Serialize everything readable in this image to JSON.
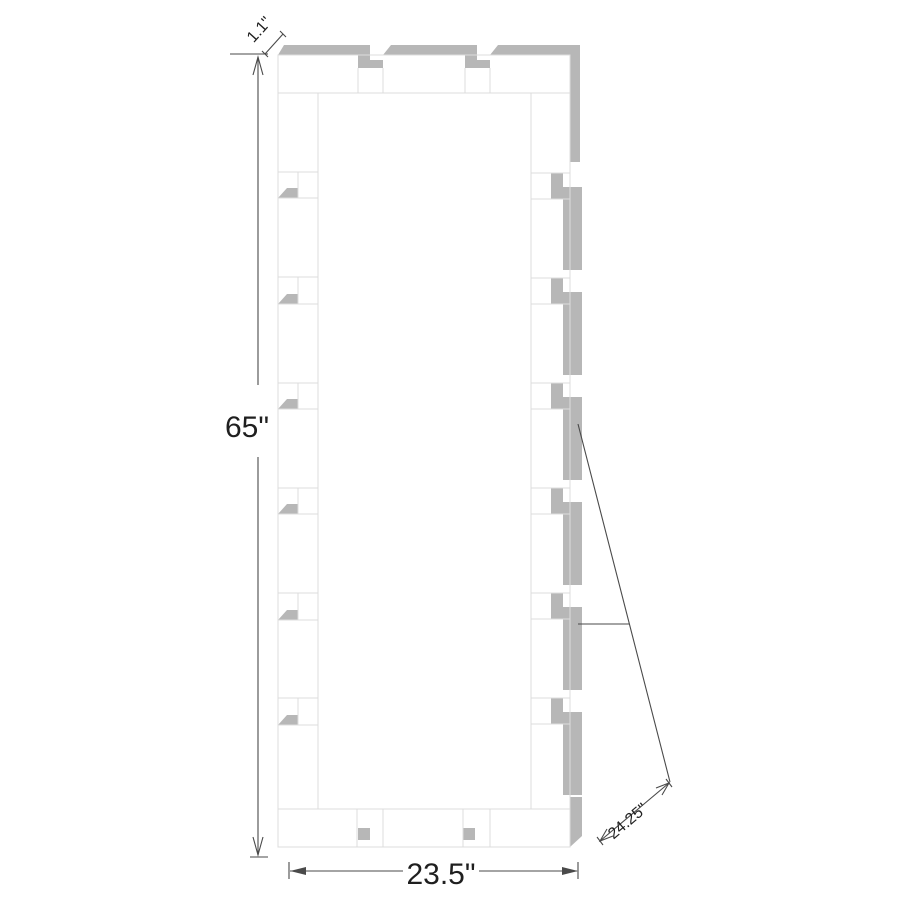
{
  "diagram": {
    "labels": {
      "depth": "1.1\"",
      "height": "65\"",
      "width": "23.5\"",
      "diagonal": "24.25\""
    },
    "colors": {
      "background": "#ffffff",
      "surface": "#b7b7b7",
      "outline": "#dcdcdc",
      "dimension": "#4a4a4a",
      "text": "#1f1f1f"
    }
  }
}
